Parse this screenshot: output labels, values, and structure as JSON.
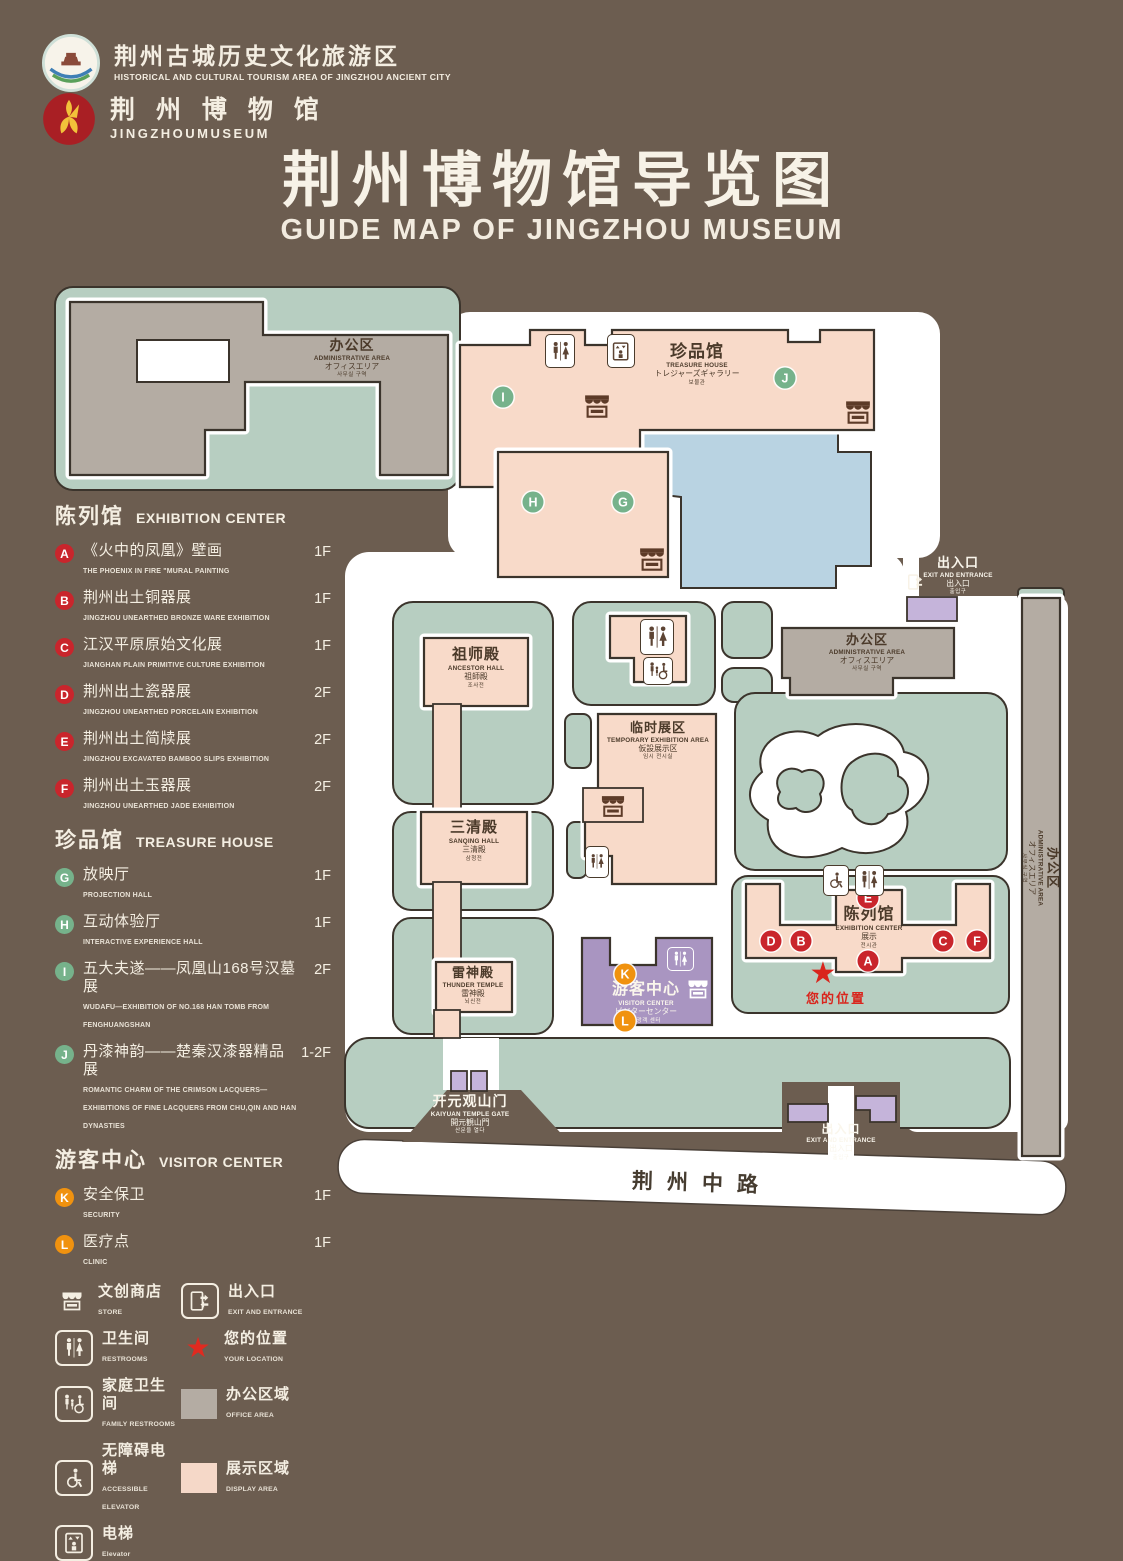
{
  "palette": {
    "background": "#6c5d50",
    "path_white": "#ffffff",
    "green_area": "#b7cec1",
    "display_pink": "#f8dac9",
    "office_gray": "#b4aca3",
    "lake_blue": "#b9d3e2",
    "visitor_purple": "#a995c1",
    "entrance_lilac": "#c5b4da",
    "badge_red": "#c9252c",
    "badge_green": "#76b28b",
    "badge_orange": "#f0920f",
    "icon_brown": "#5d4434",
    "star_red": "#d9251d"
  },
  "header": {
    "org_logo": {
      "cn": "荆州古城历史文化旅游区",
      "en": "HISTORICAL AND CULTURAL TOURISM AREA OF JINGZHOU ANCIENT CITY"
    },
    "museum_logo": {
      "cn": "荆 州 博 物 馆",
      "en": "JINGZHOUMUSEUM"
    },
    "title_cn": "荆州博物馆导览图",
    "title_en": "GUIDE MAP OF JINGZHOU MUSEUM"
  },
  "sidebar": {
    "sections": [
      {
        "cn": "陈列馆",
        "en": "EXHIBITION CENTER",
        "items": [
          {
            "letter": "A",
            "cn": "《火中的凤凰》壁画",
            "en": "THE PHOENIX IN FIRE \"MURAL PAINTING",
            "floor": "1F"
          },
          {
            "letter": "B",
            "cn": "荆州出土铜器展",
            "en": "JINGZHOU UNEARTHED BRONZE WARE EXHIBITION",
            "floor": "1F"
          },
          {
            "letter": "C",
            "cn": "江汉平原原始文化展",
            "en": "JIANGHAN PLAIN PRIMITIVE CULTURE EXHIBITION",
            "floor": "1F"
          },
          {
            "letter": "D",
            "cn": "荆州出土瓷器展",
            "en": "JINGZHOU UNEARTHED PORCELAIN EXHIBITION",
            "floor": "2F"
          },
          {
            "letter": "E",
            "cn": "荆州出土简牍展",
            "en": "JINGZHOU EXCAVATED BAMBOO SLIPS EXHIBITION",
            "floor": "2F"
          },
          {
            "letter": "F",
            "cn": "荆州出土玉器展",
            "en": "JINGZHOU UNEARTHED JADE EXHIBITION",
            "floor": "2F"
          }
        ]
      },
      {
        "cn": "珍品馆",
        "en": "TREASURE HOUSE",
        "items": [
          {
            "letter": "G",
            "cn": "放映厅",
            "en": "PROJECTION HALL",
            "floor": "1F"
          },
          {
            "letter": "H",
            "cn": "互动体验厅",
            "en": "INTERACTIVE EXPERIENCE HALL",
            "floor": "1F"
          },
          {
            "letter": "I",
            "cn": "五大夫遂——凤凰山168号汉墓展",
            "en": "WUDAFU—EXHIBITION OF NO.168 HAN TOMB FROM FENGHUANGSHAN",
            "floor": "2F"
          },
          {
            "letter": "J",
            "cn": "丹漆神韵——楚秦汉漆器精品展",
            "en": "ROMANTIC CHARM OF THE CRIMSON LACQUERS—EXHIBITIONS OF FINE LACQUERS FROM CHU,QIN AND HAN DYNASTIES",
            "floor": "1-2F"
          }
        ]
      },
      {
        "cn": "游客中心",
        "en": "VISITOR CENTER",
        "items": [
          {
            "letter": "K",
            "cn": "安全保卫",
            "en": "SECURITY",
            "floor": "1F"
          },
          {
            "letter": "L",
            "cn": "医疗点",
            "en": "CLINIC",
            "floor": "1F"
          }
        ]
      }
    ],
    "legend": [
      {
        "cn": "文创商店",
        "en": "STORE"
      },
      {
        "cn": "出入口",
        "en": "EXIT AND ENTRANCE"
      },
      {
        "cn": "卫生间",
        "en": "RESTROOMS"
      },
      {
        "cn": "您的位置",
        "en": "YOUR LOCATION"
      },
      {
        "cn": "家庭卫生间",
        "en": "FAMILY RESTROOMS"
      },
      {
        "cn": "办公区域",
        "en": "OFFICE AREA"
      },
      {
        "cn": "无障碍电梯",
        "en": "ACCESSIBLE ELEVATOR"
      },
      {
        "cn": "展示区域",
        "en": "DISPLAY AREA"
      },
      {
        "cn": "电梯",
        "en": "Elevator"
      }
    ]
  },
  "map": {
    "treasure_house": {
      "cn": "珍品馆",
      "en": "TREASURE HOUSE",
      "jp": "トレジャーズギャラリー",
      "kr": "보물관"
    },
    "admin": {
      "cn": "办公区",
      "en": "ADMINISTRATIVE AREA",
      "jp": "オフィスエリア",
      "kr": "사무실 구역"
    },
    "ancestor_hall": {
      "cn": "祖师殿",
      "en": "ANCESTOR HALL",
      "jp": "祖師殿",
      "kr": "조사전"
    },
    "sanqing_hall": {
      "cn": "三清殿",
      "en": "SANQING HALL",
      "jp": "三清殿",
      "kr": "삼청전"
    },
    "thunder_temple": {
      "cn": "雷神殿",
      "en": "THUNDER TEMPLE",
      "jp": "雷神殿",
      "kr": "뇌신전"
    },
    "temporary_exhibition": {
      "cn": "临时展区",
      "en": "TEMPORARY EXHIBITION AREA",
      "jp": "仮設展示区",
      "kr": "임시 전시실"
    },
    "exhibition_center": {
      "cn": "陈列馆",
      "en": "EXHIBITION CENTER",
      "jp": "展示",
      "kr": "전시관"
    },
    "visitor_center": {
      "cn": "游客中心",
      "en": "VISITOR CENTER",
      "jp": "ビジターセンター",
      "kr": "관광객 센터"
    },
    "entrance": {
      "cn": "出入口",
      "en": "EXIT AND ENTRANCE",
      "jp": "出入口",
      "kr": "출입구"
    },
    "gate": {
      "cn": "开元观山门",
      "en": "KAIYUAN TEMPLE GATE",
      "jp": "開元観山門",
      "kr": "산문을 열다"
    },
    "your_location": "您的位置",
    "road": "荆州中路",
    "badges": {
      "A": "A",
      "B": "B",
      "C": "C",
      "D": "D",
      "E": "E",
      "F": "F",
      "G": "G",
      "H": "H",
      "I": "I",
      "J": "J",
      "K": "K",
      "L": "L"
    }
  }
}
